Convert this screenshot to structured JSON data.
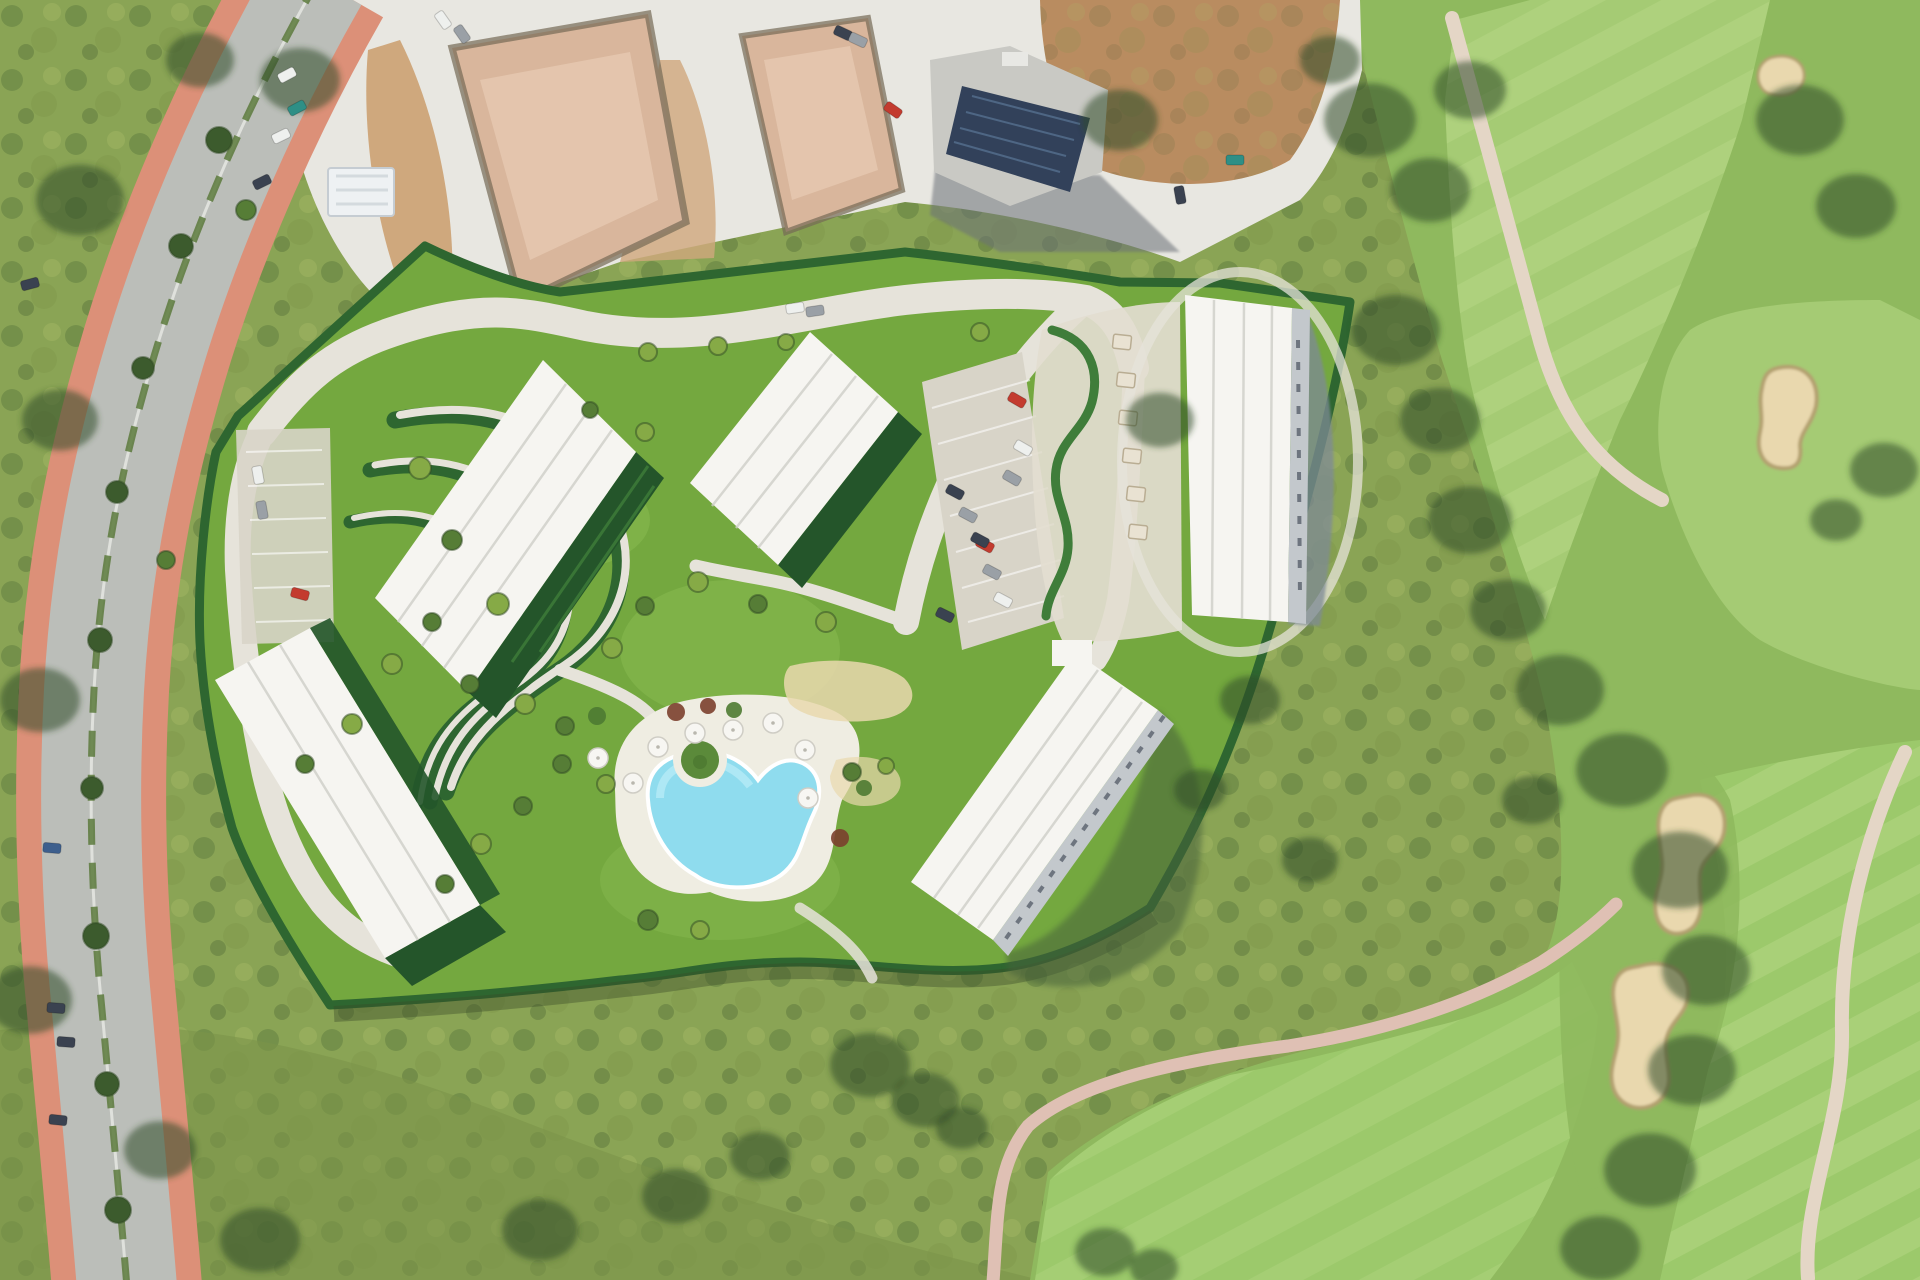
{
  "meta": {
    "description": "Aerial satellite render of a Mediterranean resort masterplan: five white apartment blocks with terraced serpentine gardens and a freeform pool, bordered by a curved avenue with terracotta sidewalks on the west, construction plots with a solar-roofed building to the north, and a golf course with sand bunkers and cart paths to the east.",
    "view": "top-down-aerial",
    "visible_text": "none"
  },
  "palette": {
    "scrub_base": "#8aa455",
    "scrub_olive": "#7c9449",
    "scrub_light": "#aabd68",
    "tree_dark": "#3c5b2d",
    "tree_darker": "#2f4a24",
    "golf_fairway": "#a5cb74",
    "golf_fairway_smooth": "#9cc96b",
    "golf_stripe": "#b9da87",
    "golf_rough": "#8fb95e",
    "bunker_sand": "#e9d8ae",
    "bunker_rim": "#b3a070",
    "cart_path": "#e4d6c6",
    "pink_path": "#dfc0b4",
    "road_asphalt": "#bbbeb9",
    "road_light": "#cfd1cd",
    "sidewalk": "#dc9078",
    "median_green": "#5c7a3c",
    "gravel": "#e8e7e1",
    "gravel_shade": "#d3d2cb",
    "dirt": "#b98c60",
    "dirt_light": "#cfa87d",
    "slab": "#d9b69c",
    "slab_light": "#e6c9b2",
    "trench": "#756a55",
    "solar_roof": "#32415a",
    "concrete": "#c9c9c4",
    "site_lawn": "#74a83f",
    "site_lawn_light": "#8abb52",
    "hedge": "#2e6630",
    "hedge_light": "#3f7d3a",
    "garden_dark": "#24552a",
    "path_cream": "#e6e3da",
    "building_white": "#f6f5f1",
    "building_shade": "#d8d8d3",
    "roof_line": "#cfcfc9",
    "balcony_grey": "#c3c8cc",
    "shadow_blue": "#7e8a96",
    "shadow_dark": "#47623a",
    "pool_water": "#8fdcee",
    "pool_light": "#b5ebf6",
    "deck": "#efede2",
    "terrace_beige": "#e3ddd0",
    "parking_gravel": "#d8d4c8",
    "umbrella_white": "#f7f6f2",
    "car_red": "#c33b2f",
    "car_white": "#eef0ee",
    "car_grey": "#9aa0a6",
    "car_dark": "#3a4250",
    "car_blue": "#3d5f8d",
    "car_teal": "#2e8f86",
    "shrub_red": "#7b3f2e",
    "shrub_green": "#4e7a32"
  },
  "scene": {
    "regions": [
      {
        "name": "west-avenue",
        "kind": "dual-carriageway with terracotta sidewalks"
      },
      {
        "name": "construction-zone",
        "kind": "graded plots, slab foundations, building with solar roof"
      },
      {
        "name": "resort-site",
        "kind": "five white blocks, gardens, pool, parking"
      },
      {
        "name": "golf-course",
        "kind": "fairways, bunkers, cart paths"
      },
      {
        "name": "scrubland",
        "kind": "wild mediterranean scrub"
      }
    ],
    "cars": [
      {
        "x": 287,
        "y": 75,
        "a": -28,
        "c": "car_white"
      },
      {
        "x": 297,
        "y": 108,
        "a": -28,
        "c": "car_teal"
      },
      {
        "x": 281,
        "y": 136,
        "a": -26,
        "c": "car_white"
      },
      {
        "x": 262,
        "y": 182,
        "a": -26,
        "c": "car_dark"
      },
      {
        "x": 30,
        "y": 284,
        "a": -15,
        "c": "car_dark"
      },
      {
        "x": 52,
        "y": 848,
        "a": 5,
        "c": "car_blue"
      },
      {
        "x": 56,
        "y": 1008,
        "a": 4,
        "c": "car_dark"
      },
      {
        "x": 66,
        "y": 1042,
        "a": 4,
        "c": "car_dark"
      },
      {
        "x": 58,
        "y": 1120,
        "a": 6,
        "c": "car_dark"
      },
      {
        "x": 443,
        "y": 20,
        "a": 55,
        "c": "car_white"
      },
      {
        "x": 462,
        "y": 34,
        "a": 55,
        "c": "car_grey"
      },
      {
        "x": 843,
        "y": 33,
        "a": 25,
        "c": "car_dark"
      },
      {
        "x": 858,
        "y": 40,
        "a": 25,
        "c": "car_grey"
      },
      {
        "x": 893,
        "y": 110,
        "a": 35,
        "c": "car_red"
      },
      {
        "x": 1235,
        "y": 160,
        "a": 0,
        "c": "car_teal"
      },
      {
        "x": 1180,
        "y": 195,
        "a": 80,
        "c": "car_dark"
      },
      {
        "x": 795,
        "y": 308,
        "a": -8,
        "c": "car_white"
      },
      {
        "x": 815,
        "y": 311,
        "a": -8,
        "c": "car_grey"
      },
      {
        "x": 300,
        "y": 594,
        "a": 15,
        "c": "car_red"
      },
      {
        "x": 1017,
        "y": 400,
        "a": 30,
        "c": "car_red"
      },
      {
        "x": 1023,
        "y": 448,
        "a": 30,
        "c": "car_white"
      },
      {
        "x": 1012,
        "y": 478,
        "a": 30,
        "c": "car_grey"
      },
      {
        "x": 985,
        "y": 545,
        "a": 28,
        "c": "car_red"
      },
      {
        "x": 955,
        "y": 492,
        "a": 28,
        "c": "car_dark"
      },
      {
        "x": 968,
        "y": 515,
        "a": 28,
        "c": "car_grey"
      },
      {
        "x": 980,
        "y": 540,
        "a": 28,
        "c": "car_dark"
      },
      {
        "x": 992,
        "y": 572,
        "a": 28,
        "c": "car_grey"
      },
      {
        "x": 1003,
        "y": 600,
        "a": 28,
        "c": "car_white"
      },
      {
        "x": 945,
        "y": 615,
        "a": 26,
        "c": "car_dark"
      },
      {
        "x": 258,
        "y": 475,
        "a": 80,
        "c": "car_white"
      },
      {
        "x": 262,
        "y": 510,
        "a": 80,
        "c": "car_grey"
      }
    ],
    "trees": [
      {
        "x": 219,
        "y": 140,
        "r": 13,
        "t": "dark"
      },
      {
        "x": 181,
        "y": 246,
        "r": 12,
        "t": "dark"
      },
      {
        "x": 143,
        "y": 368,
        "r": 11,
        "t": "dark"
      },
      {
        "x": 117,
        "y": 492,
        "r": 11,
        "t": "dark"
      },
      {
        "x": 100,
        "y": 640,
        "r": 12,
        "t": "dark"
      },
      {
        "x": 92,
        "y": 788,
        "r": 11,
        "t": "dark"
      },
      {
        "x": 96,
        "y": 936,
        "r": 13,
        "t": "dark"
      },
      {
        "x": 107,
        "y": 1084,
        "r": 12,
        "t": "dark"
      },
      {
        "x": 118,
        "y": 1210,
        "r": 13,
        "t": "dark"
      },
      {
        "x": 246,
        "y": 210,
        "r": 10,
        "t": "mid"
      },
      {
        "x": 166,
        "y": 560,
        "r": 9,
        "t": "mid"
      },
      {
        "x": 648,
        "y": 352,
        "r": 9,
        "t": "light"
      },
      {
        "x": 718,
        "y": 346,
        "r": 9,
        "t": "light"
      },
      {
        "x": 786,
        "y": 342,
        "r": 8,
        "t": "light"
      },
      {
        "x": 980,
        "y": 332,
        "r": 9,
        "t": "light"
      },
      {
        "x": 420,
        "y": 468,
        "r": 11,
        "t": "light"
      },
      {
        "x": 452,
        "y": 540,
        "r": 10,
        "t": "mid"
      },
      {
        "x": 498,
        "y": 604,
        "r": 11,
        "t": "light"
      },
      {
        "x": 432,
        "y": 622,
        "r": 9,
        "t": "mid"
      },
      {
        "x": 392,
        "y": 664,
        "r": 10,
        "t": "light"
      },
      {
        "x": 470,
        "y": 684,
        "r": 9,
        "t": "mid"
      },
      {
        "x": 525,
        "y": 704,
        "r": 10,
        "t": "light"
      },
      {
        "x": 565,
        "y": 726,
        "r": 9,
        "t": "mid"
      },
      {
        "x": 612,
        "y": 648,
        "r": 10,
        "t": "light"
      },
      {
        "x": 645,
        "y": 606,
        "r": 9,
        "t": "mid"
      },
      {
        "x": 698,
        "y": 582,
        "r": 10,
        "t": "light"
      },
      {
        "x": 758,
        "y": 604,
        "r": 9,
        "t": "mid"
      },
      {
        "x": 826,
        "y": 622,
        "r": 10,
        "t": "light"
      },
      {
        "x": 562,
        "y": 764,
        "r": 9,
        "t": "mid"
      },
      {
        "x": 606,
        "y": 784,
        "r": 9,
        "t": "light"
      },
      {
        "x": 523,
        "y": 806,
        "r": 9,
        "t": "mid"
      },
      {
        "x": 481,
        "y": 844,
        "r": 10,
        "t": "light"
      },
      {
        "x": 445,
        "y": 884,
        "r": 9,
        "t": "mid"
      },
      {
        "x": 352,
        "y": 724,
        "r": 10,
        "t": "light"
      },
      {
        "x": 305,
        "y": 764,
        "r": 9,
        "t": "mid"
      },
      {
        "x": 645,
        "y": 432,
        "r": 9,
        "t": "light"
      },
      {
        "x": 590,
        "y": 410,
        "r": 8,
        "t": "mid"
      },
      {
        "x": 648,
        "y": 920,
        "r": 10,
        "t": "mid"
      },
      {
        "x": 700,
        "y": 930,
        "r": 9,
        "t": "light"
      },
      {
        "x": 852,
        "y": 772,
        "r": 9,
        "t": "mid"
      },
      {
        "x": 886,
        "y": 766,
        "r": 8,
        "t": "light"
      }
    ],
    "blobs": [
      {
        "x": 1370,
        "y": 120,
        "r": 46
      },
      {
        "x": 1430,
        "y": 190,
        "r": 40
      },
      {
        "x": 1470,
        "y": 90,
        "r": 36
      },
      {
        "x": 1800,
        "y": 120,
        "r": 44
      },
      {
        "x": 1856,
        "y": 206,
        "r": 40
      },
      {
        "x": 1884,
        "y": 470,
        "r": 34
      },
      {
        "x": 1836,
        "y": 520,
        "r": 26
      },
      {
        "x": 1396,
        "y": 330,
        "r": 44
      },
      {
        "x": 1440,
        "y": 420,
        "r": 40
      },
      {
        "x": 1470,
        "y": 520,
        "r": 42
      },
      {
        "x": 1508,
        "y": 610,
        "r": 38
      },
      {
        "x": 1560,
        "y": 690,
        "r": 44
      },
      {
        "x": 1622,
        "y": 770,
        "r": 46
      },
      {
        "x": 1680,
        "y": 870,
        "r": 48
      },
      {
        "x": 1706,
        "y": 970,
        "r": 44
      },
      {
        "x": 1692,
        "y": 1070,
        "r": 44
      },
      {
        "x": 1650,
        "y": 1170,
        "r": 46
      },
      {
        "x": 1600,
        "y": 1248,
        "r": 40
      },
      {
        "x": 1532,
        "y": 800,
        "r": 30
      },
      {
        "x": 1250,
        "y": 700,
        "r": 30
      },
      {
        "x": 1200,
        "y": 790,
        "r": 26
      },
      {
        "x": 1310,
        "y": 860,
        "r": 28
      },
      {
        "x": 870,
        "y": 1065,
        "r": 40
      },
      {
        "x": 925,
        "y": 1100,
        "r": 34
      },
      {
        "x": 962,
        "y": 1128,
        "r": 26
      },
      {
        "x": 760,
        "y": 1156,
        "r": 30
      },
      {
        "x": 676,
        "y": 1196,
        "r": 34
      },
      {
        "x": 540,
        "y": 1230,
        "r": 38
      },
      {
        "x": 1105,
        "y": 1252,
        "r": 30
      },
      {
        "x": 1154,
        "y": 1268,
        "r": 24
      },
      {
        "x": 300,
        "y": 80,
        "r": 40
      },
      {
        "x": 200,
        "y": 60,
        "r": 34
      },
      {
        "x": 80,
        "y": 200,
        "r": 44
      },
      {
        "x": 60,
        "y": 420,
        "r": 38
      },
      {
        "x": 40,
        "y": 700,
        "r": 40
      },
      {
        "x": 30,
        "y": 1000,
        "r": 42
      },
      {
        "x": 160,
        "y": 1150,
        "r": 36
      },
      {
        "x": 260,
        "y": 1240,
        "r": 40
      },
      {
        "x": 1160,
        "y": 420,
        "r": 34
      },
      {
        "x": 1120,
        "y": 120,
        "r": 38
      },
      {
        "x": 1330,
        "y": 60,
        "r": 30
      }
    ],
    "umbrellas": [
      {
        "x": 658,
        "y": 747
      },
      {
        "x": 695,
        "y": 733
      },
      {
        "x": 733,
        "y": 730
      },
      {
        "x": 773,
        "y": 723
      },
      {
        "x": 805,
        "y": 750
      },
      {
        "x": 808,
        "y": 798
      },
      {
        "x": 633,
        "y": 783
      },
      {
        "x": 598,
        "y": 758
      }
    ],
    "shrubs": [
      {
        "x": 676,
        "y": 712,
        "c": "shrub_red",
        "r": 9
      },
      {
        "x": 708,
        "y": 706,
        "c": "shrub_red",
        "r": 8
      },
      {
        "x": 734,
        "y": 710,
        "c": "shrub_green",
        "r": 8
      },
      {
        "x": 597,
        "y": 716,
        "c": "shrub_green",
        "r": 9
      },
      {
        "x": 840,
        "y": 838,
        "c": "shrub_red",
        "r": 9
      },
      {
        "x": 864,
        "y": 788,
        "c": "shrub_green",
        "r": 8
      },
      {
        "x": 700,
        "y": 762,
        "c": "shrub_green",
        "r": 7
      }
    ],
    "carports": [
      {
        "x": 1122,
        "y": 342
      },
      {
        "x": 1126,
        "y": 380
      },
      {
        "x": 1128,
        "y": 418
      },
      {
        "x": 1132,
        "y": 456
      },
      {
        "x": 1136,
        "y": 494
      },
      {
        "x": 1138,
        "y": 532
      }
    ]
  }
}
